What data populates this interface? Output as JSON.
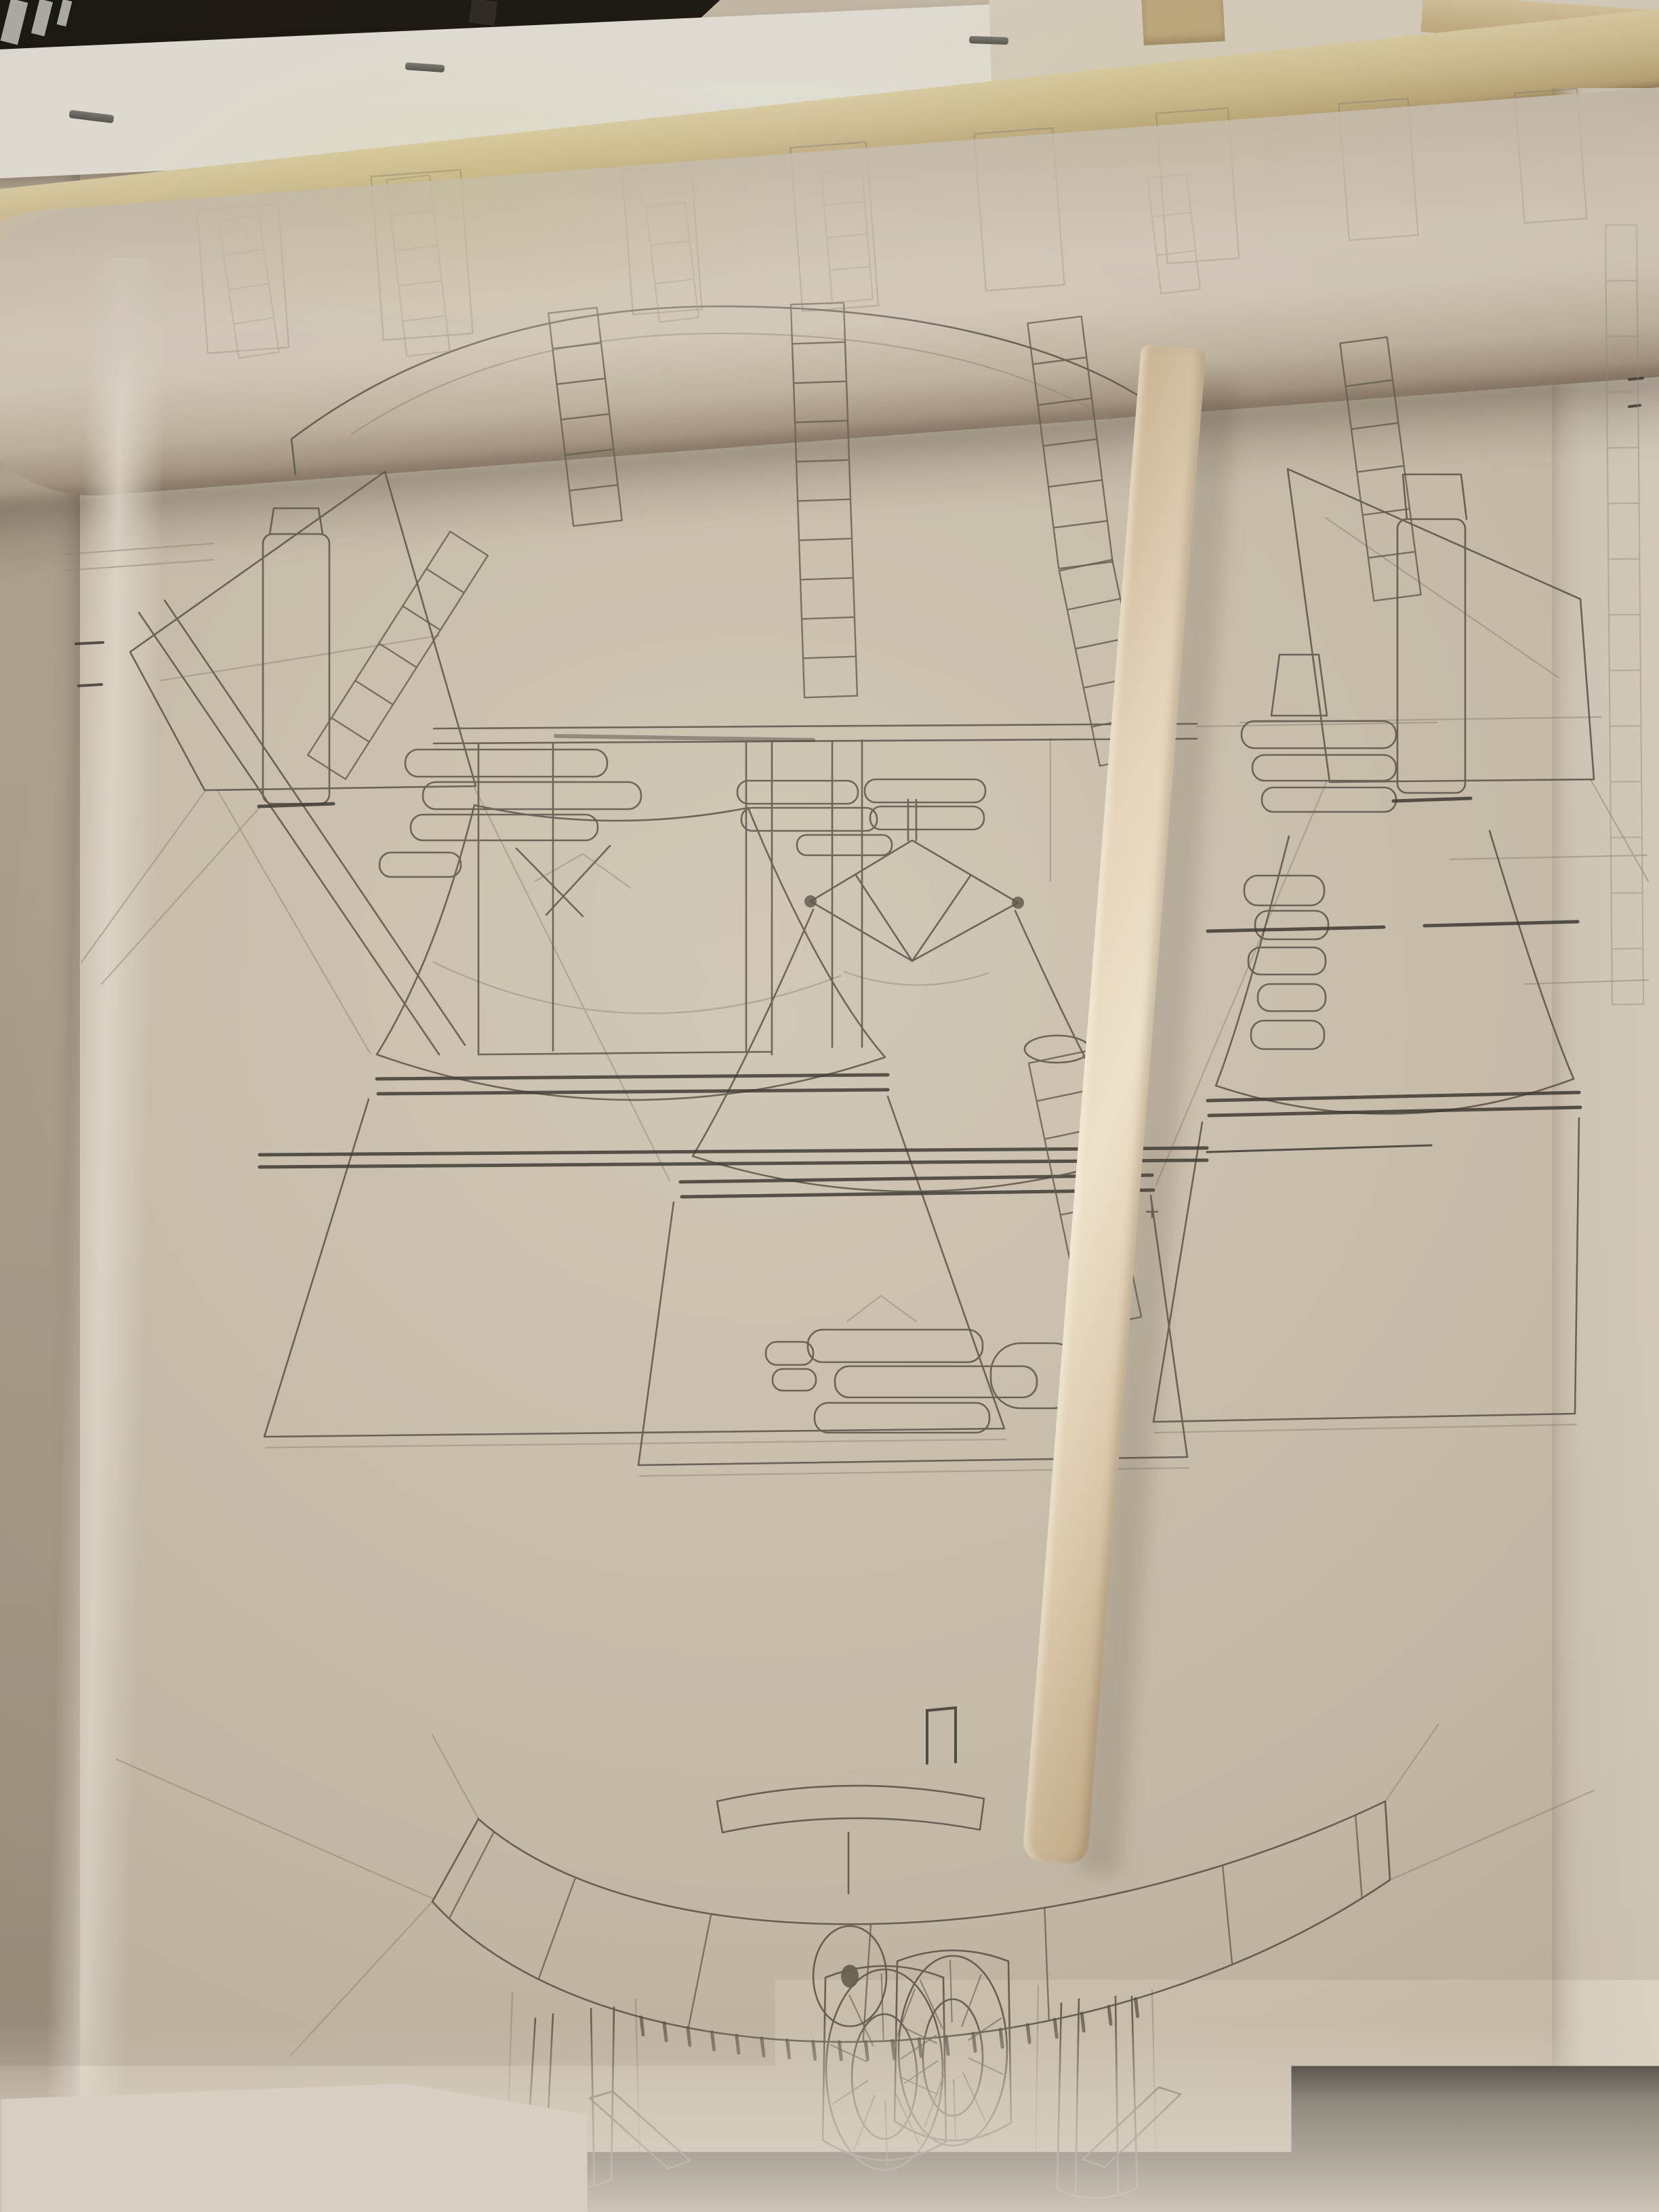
{
  "scene": {
    "type": "photograph",
    "subject": "Hand-drawn pencil engineering drawing of a three-nozzle rocket engine cluster on a large partially unrolled tracing-paper sheet, weighted by a long wooden dowel",
    "visible_text": "",
    "aria_label": "Photograph of a large rolled pencil blueprint of a rocket engine cluster, held flat by a wooden stick, with a wooden batten and stapled papers along the top edge"
  },
  "objects": {
    "blueprint_sheet": "large cream tracing-paper sheet",
    "paper_roll_top": "rolled-over top edge of the sheet",
    "paper_roll_bottom": "re-rolled bottom edge of the sheet",
    "wooden_stick": "long pale wooden dowel lying diagonally across the sheet",
    "wooden_rail": "horizontal wooden batten across the top",
    "wooden_slat_top_right": "short wooden slat at top right",
    "wood_block_top": "small wooden block at top center-right",
    "stapled_paper_left": "white stapled paper sheet at top left",
    "paper_top_right": "second paper sheet at top right",
    "staple_count": 3,
    "backing_sheet_right": "second drawing sheet visible along the right edge",
    "dark_background_top_left": "dark room background in the top left corner"
  },
  "drawing": {
    "medium": "graphite pencil on tracing paper",
    "engine_bells": 3,
    "outboard_fins": 2,
    "flexible_bellows_ducts": 7,
    "views": [
      "rear elevation of clustered rocket engines with thrust structure, plumbing and fins",
      "base heat-shield arc section with hub, scalloped edge and two engine bells (bottom of sheet)"
    ]
  },
  "colors": {
    "paper": "#cbc0ae",
    "paper_highlight": "#ded4c5",
    "paper_shadow": "#a2917e",
    "board": "#b0a391",
    "white_paper": "#e8e5db",
    "black_corner": "#17140f",
    "wood_rail": "#d2c195",
    "wood_stick": "#ead9bd",
    "pencil": "#5f584c",
    "pencil_dark": "#39342c"
  }
}
